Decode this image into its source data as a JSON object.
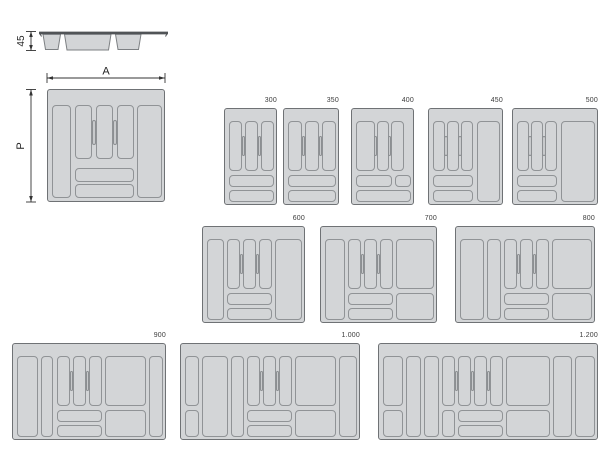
{
  "diagram": {
    "type": "product-size-diagram",
    "subject": "cutlery tray drawer organizer sizes",
    "dimensions": {
      "side_height_label": "45",
      "width_label": "A",
      "depth_label": "P"
    },
    "colors": {
      "tray_fill": "#d3d5d7",
      "tray_border": "#6f7275",
      "comp_border": "#909396",
      "grip_fill": "#c8cacc",
      "line": "#333333"
    },
    "side_view": {
      "tub_count": 3
    },
    "trays": [
      {
        "name": "tray-detail",
        "label": null,
        "x": 47,
        "y": 89,
        "w": 118,
        "h": 113,
        "grip_h": 25,
        "comps": [
          [
            4,
            15,
            19,
            93
          ],
          [
            27,
            15,
            17,
            54
          ],
          [
            48,
            15,
            17,
            54
          ],
          [
            69,
            15,
            17,
            54
          ],
          [
            89,
            15,
            25,
            93
          ],
          [
            27,
            78,
            59,
            14
          ],
          [
            27,
            94,
            59,
            14
          ]
        ],
        "grips": [
          [
            46,
            42
          ],
          [
            67,
            42
          ]
        ]
      },
      {
        "name": "tray-300",
        "label": "300",
        "x": 224,
        "y": 108,
        "w": 53,
        "h": 97,
        "grip_h": 20,
        "comps": [
          [
            4,
            12,
            13,
            50
          ],
          [
            20,
            12,
            13,
            50
          ],
          [
            36,
            12,
            13,
            50
          ],
          [
            4,
            66,
            45,
            12
          ],
          [
            4,
            81,
            45,
            12
          ]
        ],
        "grips": [
          [
            18.5,
            37
          ],
          [
            34.5,
            37
          ]
        ]
      },
      {
        "name": "tray-350",
        "label": "350",
        "x": 283,
        "y": 108,
        "w": 56,
        "h": 97,
        "grip_h": 20,
        "comps": [
          [
            4,
            12,
            14,
            50
          ],
          [
            21,
            12,
            14,
            50
          ],
          [
            38,
            12,
            14,
            50
          ],
          [
            4,
            66,
            48,
            12
          ],
          [
            4,
            81,
            48,
            12
          ]
        ],
        "grips": [
          [
            19.5,
            37
          ],
          [
            36.5,
            37
          ]
        ]
      },
      {
        "name": "tray-400",
        "label": "400",
        "x": 351,
        "y": 108,
        "w": 63,
        "h": 97,
        "grip_h": 20,
        "comps": [
          [
            4,
            12,
            19,
            50
          ],
          [
            25,
            12,
            12,
            50
          ],
          [
            39,
            12,
            13,
            50
          ],
          [
            4,
            66,
            36,
            12
          ],
          [
            43,
            66,
            16,
            12
          ],
          [
            4,
            81,
            55,
            12
          ]
        ],
        "grips": [
          [
            23.5,
            37
          ],
          [
            37.5,
            37
          ]
        ]
      },
      {
        "name": "tray-450",
        "label": "450",
        "x": 428,
        "y": 108,
        "w": 75,
        "h": 97,
        "grip_h": 20,
        "comps": [
          [
            4,
            12,
            12,
            50
          ],
          [
            18,
            12,
            12,
            50
          ],
          [
            32,
            12,
            12,
            50
          ],
          [
            48,
            12,
            23,
            81
          ],
          [
            4,
            66,
            40,
            12
          ],
          [
            4,
            81,
            40,
            12
          ]
        ],
        "grips": [
          [
            17,
            37
          ],
          [
            31,
            37
          ]
        ]
      },
      {
        "name": "tray-500",
        "label": "500",
        "x": 512,
        "y": 108,
        "w": 86,
        "h": 97,
        "grip_h": 20,
        "comps": [
          [
            4,
            12,
            12,
            50
          ],
          [
            18,
            12,
            12,
            50
          ],
          [
            32,
            12,
            12,
            50
          ],
          [
            48,
            12,
            34,
            81
          ],
          [
            4,
            66,
            40,
            12
          ],
          [
            4,
            81,
            40,
            12
          ]
        ],
        "grips": [
          [
            17,
            37
          ],
          [
            31,
            37
          ]
        ]
      },
      {
        "name": "tray-600",
        "label": "600",
        "x": 202,
        "y": 226,
        "w": 103,
        "h": 97,
        "grip_h": 20,
        "comps": [
          [
            4,
            12,
            17,
            81
          ],
          [
            24,
            12,
            13,
            50
          ],
          [
            40,
            12,
            13,
            50
          ],
          [
            56,
            12,
            13,
            50
          ],
          [
            72,
            12,
            27,
            81
          ],
          [
            24,
            66,
            45,
            12
          ],
          [
            24,
            81,
            45,
            12
          ]
        ],
        "grips": [
          [
            38.5,
            37
          ],
          [
            54.5,
            37
          ]
        ]
      },
      {
        "name": "tray-700",
        "label": "700",
        "x": 320,
        "y": 226,
        "w": 117,
        "h": 97,
        "grip_h": 20,
        "comps": [
          [
            4,
            12,
            20,
            81
          ],
          [
            27,
            12,
            13,
            50
          ],
          [
            43,
            12,
            13,
            50
          ],
          [
            59,
            12,
            13,
            50
          ],
          [
            75,
            12,
            38,
            50
          ],
          [
            75,
            66,
            38,
            27
          ],
          [
            27,
            66,
            45,
            12
          ],
          [
            27,
            81,
            45,
            12
          ]
        ],
        "grips": [
          [
            41.5,
            37
          ],
          [
            57.5,
            37
          ]
        ]
      },
      {
        "name": "tray-800",
        "label": "800",
        "x": 455,
        "y": 226,
        "w": 140,
        "h": 97,
        "grip_h": 20,
        "comps": [
          [
            4,
            12,
            24,
            81
          ],
          [
            31,
            12,
            14,
            81
          ],
          [
            48,
            12,
            13,
            50
          ],
          [
            64,
            12,
            13,
            50
          ],
          [
            80,
            12,
            13,
            50
          ],
          [
            96,
            12,
            40,
            50
          ],
          [
            96,
            66,
            40,
            27
          ],
          [
            48,
            66,
            45,
            12
          ],
          [
            48,
            81,
            45,
            12
          ]
        ],
        "grips": [
          [
            62.5,
            37
          ],
          [
            78.5,
            37
          ]
        ]
      },
      {
        "name": "tray-900",
        "label": "900",
        "x": 12,
        "y": 343,
        "w": 154,
        "h": 97,
        "grip_h": 20,
        "comps": [
          [
            4,
            12,
            21,
            81
          ],
          [
            28,
            12,
            12,
            81
          ],
          [
            44,
            12,
            13,
            50
          ],
          [
            60,
            12,
            13,
            50
          ],
          [
            76,
            12,
            13,
            50
          ],
          [
            92,
            12,
            41,
            50
          ],
          [
            92,
            66,
            41,
            27
          ],
          [
            44,
            66,
            45,
            12
          ],
          [
            44,
            81,
            45,
            12
          ],
          [
            136,
            12,
            14,
            81
          ]
        ],
        "grips": [
          [
            58.5,
            37
          ],
          [
            74.5,
            37
          ]
        ]
      },
      {
        "name": "tray-1000",
        "label": "1.000",
        "x": 180,
        "y": 343,
        "w": 180,
        "h": 97,
        "grip_h": 20,
        "comps": [
          [
            4,
            12,
            14,
            50
          ],
          [
            4,
            66,
            14,
            27
          ],
          [
            21,
            12,
            26,
            81
          ],
          [
            50,
            12,
            13,
            81
          ],
          [
            66,
            12,
            13,
            50
          ],
          [
            82,
            12,
            13,
            50
          ],
          [
            98,
            12,
            13,
            50
          ],
          [
            66,
            66,
            45,
            12
          ],
          [
            66,
            81,
            45,
            12
          ],
          [
            114,
            12,
            41,
            50
          ],
          [
            114,
            66,
            41,
            27
          ],
          [
            158,
            12,
            18,
            81
          ]
        ],
        "grips": [
          [
            80.5,
            37
          ],
          [
            96.5,
            37
          ]
        ]
      },
      {
        "name": "tray-1200",
        "label": "1.200",
        "x": 378,
        "y": 343,
        "w": 220,
        "h": 97,
        "grip_h": 20,
        "comps": [
          [
            4,
            12,
            20,
            50
          ],
          [
            4,
            66,
            20,
            27
          ],
          [
            27,
            12,
            15,
            81
          ],
          [
            45,
            12,
            15,
            81
          ],
          [
            63,
            12,
            13,
            50
          ],
          [
            63,
            66,
            13,
            27
          ],
          [
            79,
            12,
            13,
            50
          ],
          [
            95,
            12,
            13,
            50
          ],
          [
            111,
            12,
            13,
            50
          ],
          [
            79,
            66,
            45,
            12
          ],
          [
            79,
            81,
            45,
            12
          ],
          [
            127,
            12,
            44,
            50
          ],
          [
            127,
            66,
            44,
            27
          ],
          [
            174,
            12,
            19,
            81
          ],
          [
            196,
            12,
            20,
            81
          ]
        ],
        "grips": [
          [
            77.5,
            37
          ],
          [
            93.5,
            37
          ],
          [
            109.5,
            37
          ]
        ]
      }
    ]
  }
}
